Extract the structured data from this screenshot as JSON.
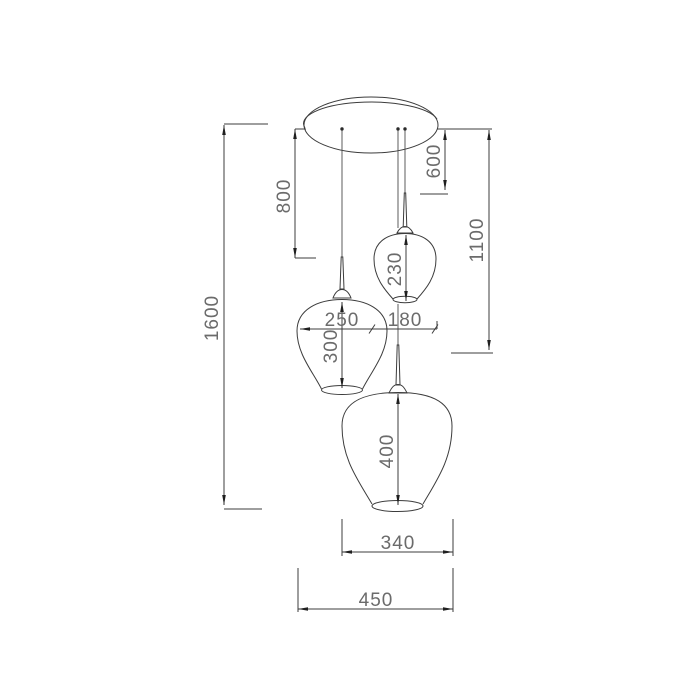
{
  "dimensions": {
    "total_height": "1600",
    "cord_length_left": "800",
    "cord_length_right": "600",
    "drop_to_medium_shade": "1100",
    "small_shade_height": "230",
    "medium_shade_width": "250",
    "small_shade_width": "180",
    "medium_shade_height": "300",
    "large_shade_height": "400",
    "large_shade_width": "340",
    "overall_width": "450"
  }
}
